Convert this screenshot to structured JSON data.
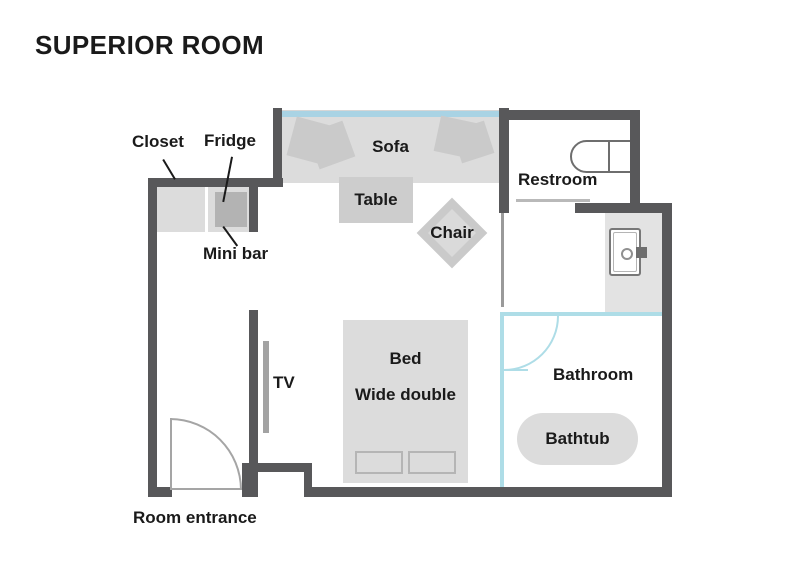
{
  "title": "SUPERIOR ROOM",
  "labels": {
    "closet": "Closet",
    "fridge": "Fridge",
    "mini_bar": "Mini bar",
    "sofa": "Sofa",
    "table": "Table",
    "chair": "Chair",
    "restroom": "Restroom",
    "tv": "TV",
    "bed_line1": "Bed",
    "bed_line2": "Wide double",
    "bathroom": "Bathroom",
    "bathtub": "Bathtub",
    "room_entrance": "Room entrance"
  },
  "icons": {
    "toilet": "toilet-top-view-icon",
    "sink": "sink-top-view-icon",
    "entrance_door": "door-swing-arc-icon",
    "bathroom_door": "door-swing-arc-icon",
    "tv": "wall-tv-bar-icon",
    "sofa_cushions": "cushion-shape-icon",
    "bed_pillows": "pillow-outline-icon"
  },
  "colors": {
    "wall": "#58585a",
    "furniture": "#dcdcdc",
    "furniture_mid": "#cacaca",
    "fridge": "#b3b3b3",
    "vanity": "#e3e3e3",
    "window": "#a9d3e4",
    "bathroom_wall": "#aedde7",
    "door_line": "#b9b9b9",
    "outline": "#787878",
    "text": "#1a1a1a"
  }
}
